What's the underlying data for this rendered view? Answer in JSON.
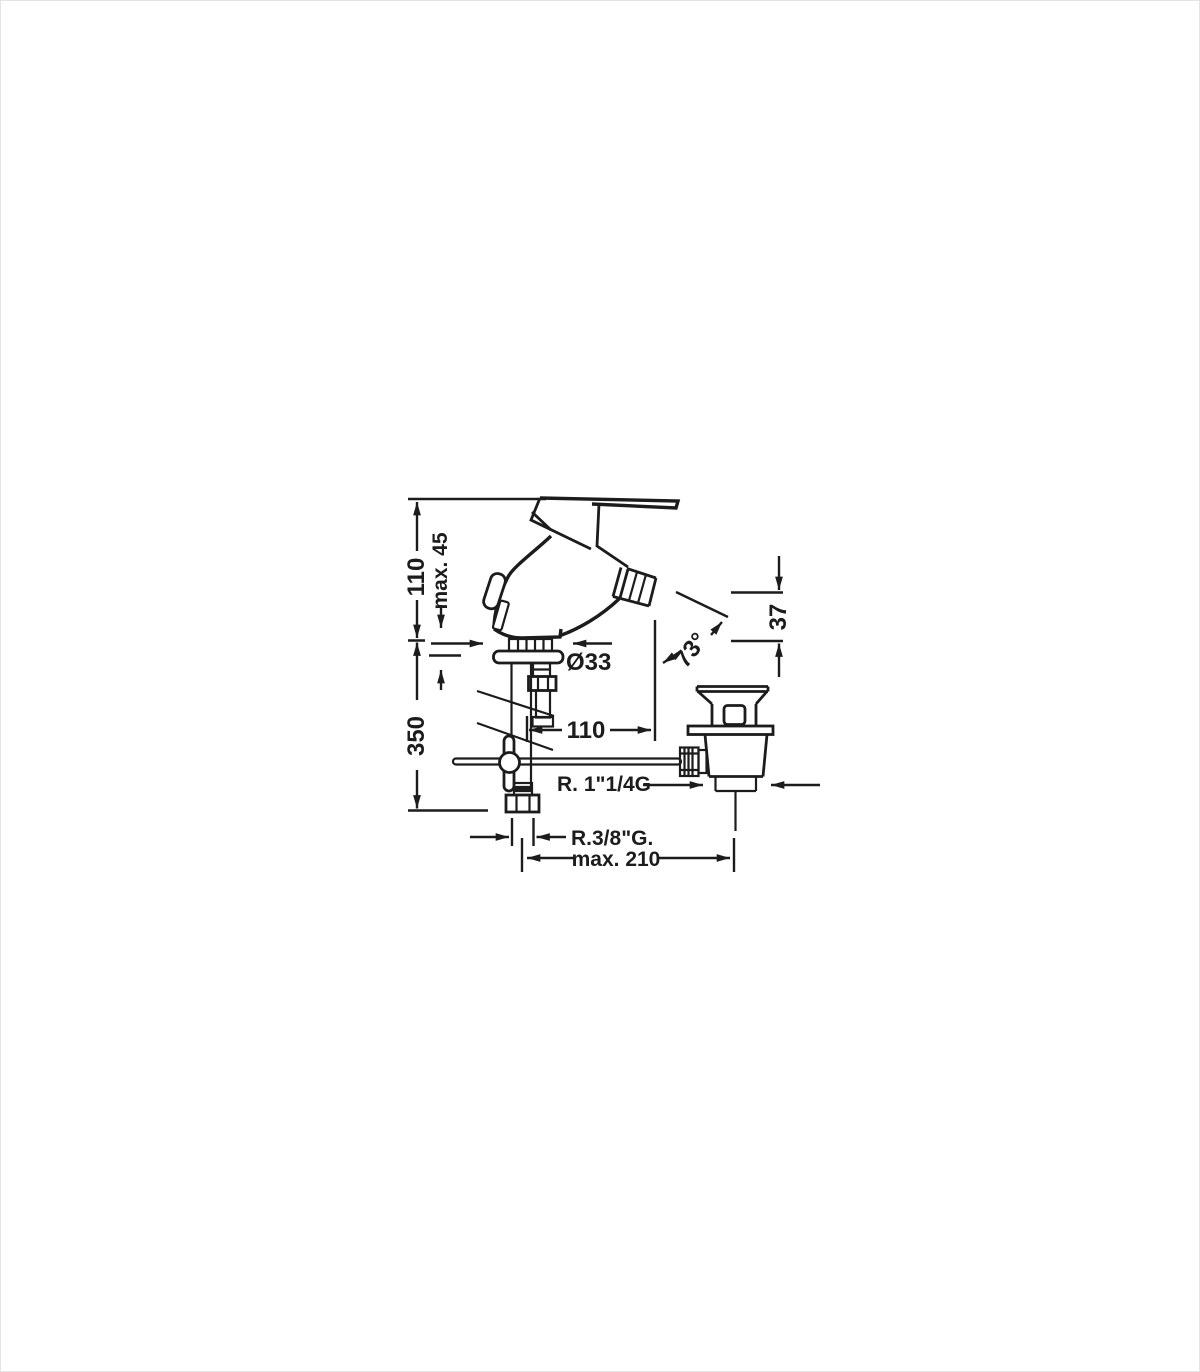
{
  "frame": {
    "background": "#ffffff",
    "border_color": "#e4e4e4",
    "ink_color": "#1c1c1c"
  },
  "drawing": {
    "labels": {
      "body_height": "110",
      "deck_thickness": "max. 45",
      "under_deck_depth": "350",
      "hole_diameter": "Ø33",
      "spout_reach": "110",
      "spout_angle": "73°",
      "outlet_height": "37",
      "waste_thread": "R. 1\"1/4G",
      "supply_thread": "R.3/8\"G.",
      "max_span": "max. 210"
    }
  }
}
